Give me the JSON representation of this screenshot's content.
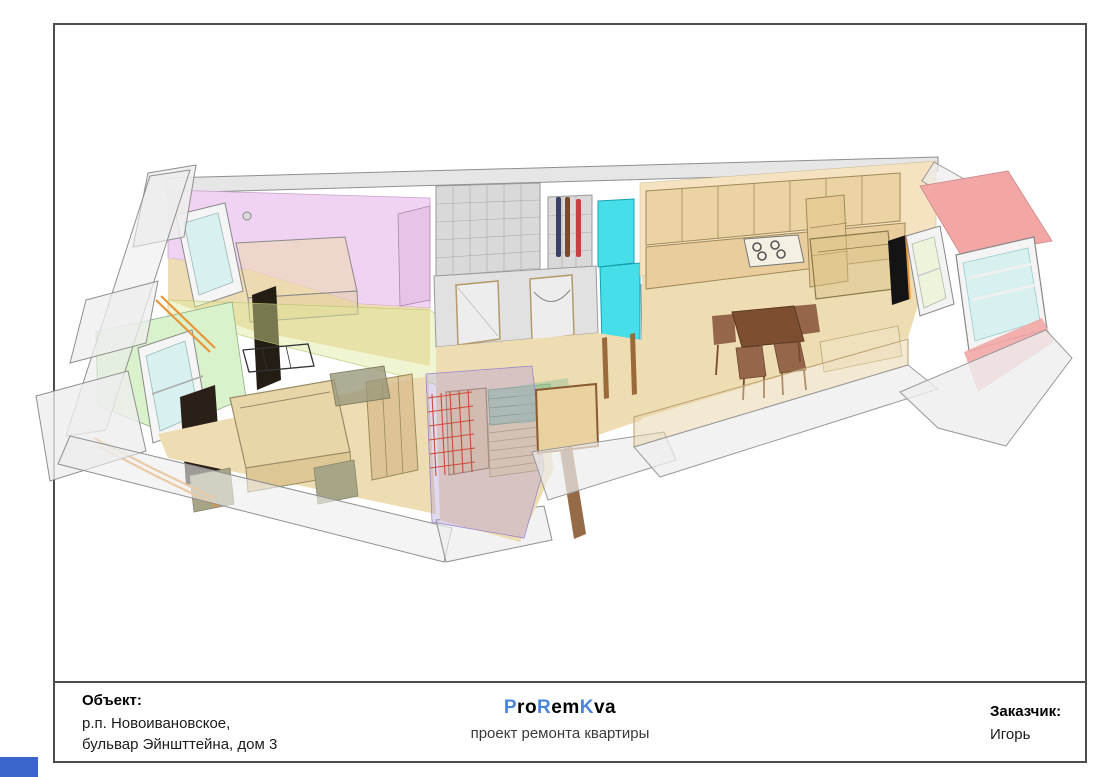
{
  "title_block": {
    "object_label": "Объект:",
    "object_address_line1": "р.п. Новоивановское,",
    "object_address_line2": "бульвар Эйншттейна, дом 3",
    "brand_parts": [
      "P",
      "ro",
      "R",
      "em",
      "K",
      "va"
    ],
    "brand_accent_color": "#4a86d8",
    "subtitle": "проект ремонта квартиры",
    "customer_label": "Заказчик:",
    "customer_name": "Игорь"
  },
  "drawing": {
    "type": "3d-apartment-renovation-axonometric-render",
    "palette": {
      "shell_gray": "#ededed",
      "tile_gray": "#d9d9d9",
      "floor_tan": "#eedcb2",
      "wall_tan": "#f4e2c0",
      "pink": "#f0d3f2",
      "green": "#d9f2cb",
      "cyan": "#45dee9",
      "red": "#f2a7a5",
      "glass": "#d8f1f0",
      "overlay_yellow": "#dde89a",
      "overlay_purple": "#b49fd9",
      "step_green": "#9cc79a",
      "step_tan": "#ead9a0",
      "grid_red": "#d04838",
      "cabinet_tan": "#ecd3a4",
      "wood_brown": "#7d4f30",
      "chair_brown": "#96664a",
      "pipe_orange": "#e8953a",
      "tv_black": "#141414"
    }
  }
}
